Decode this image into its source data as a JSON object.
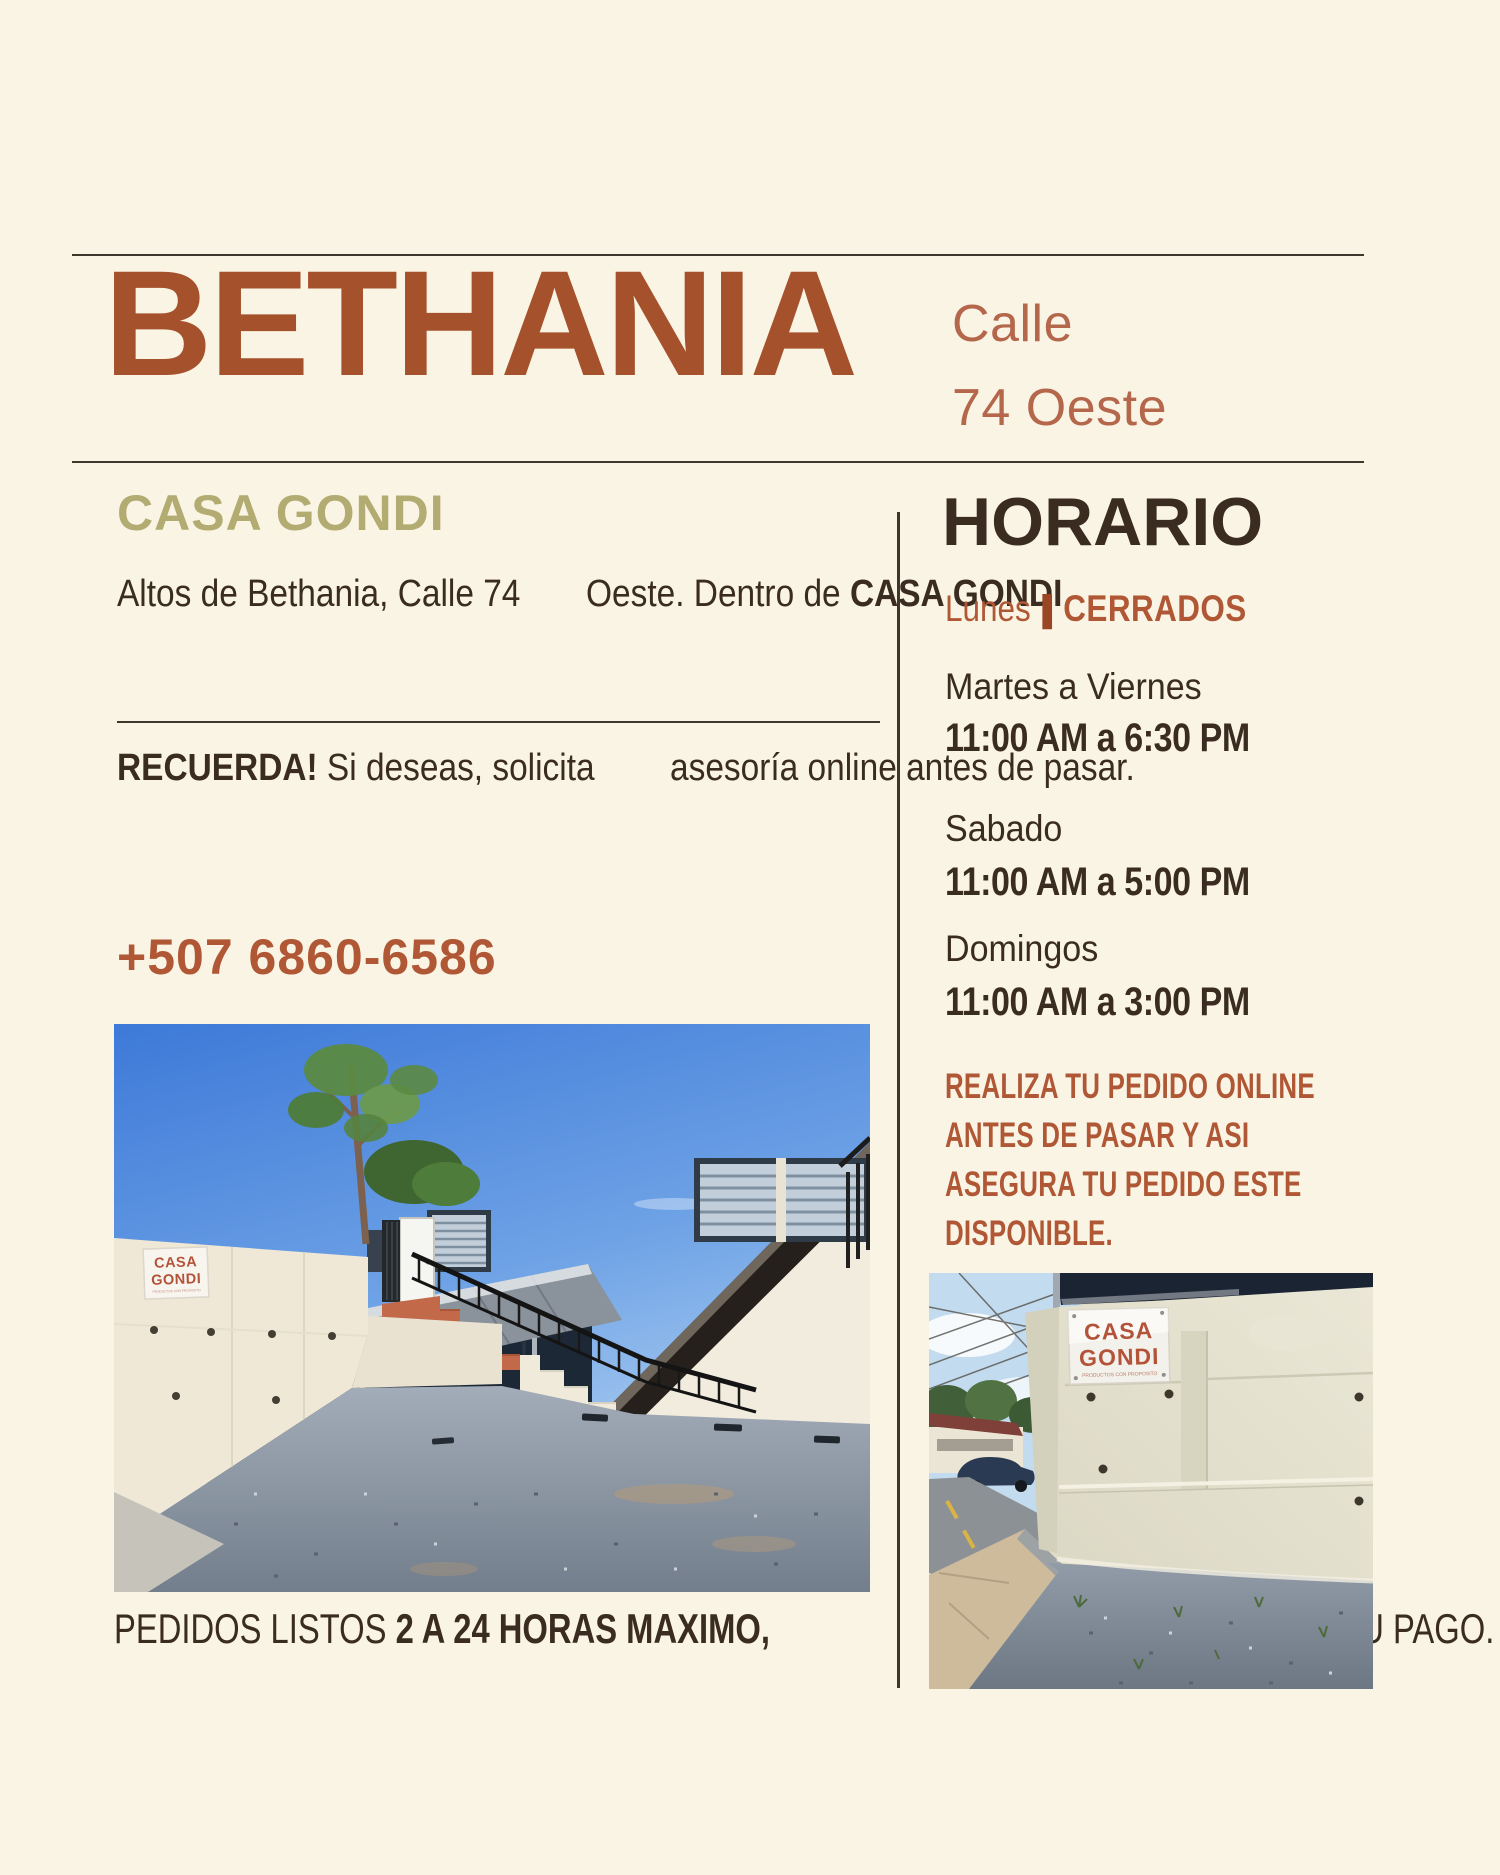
{
  "colors": {
    "background": "#FAF4E5",
    "title": "#A5512C",
    "subtitle": "#B4674B",
    "brand": "#B2AB72",
    "text_dark": "#3B2C21",
    "rust": "#B05836",
    "rust_deep": "#9A4524",
    "line": "#3E352C"
  },
  "header": {
    "title": "BETHANIA",
    "subtitle_line1": "Calle",
    "subtitle_line2": "74 Oeste"
  },
  "left_column": {
    "brand": "CASA GONDI",
    "address_line1": "Altos de Bethania, Calle 74",
    "address_line2_text": "Oeste. Dentro de ",
    "address_line2_emphasis": "CASA GONDI",
    "reminder_emphasis": "RECUERDA!",
    "reminder_line1_rest": " Si deseas, solicita",
    "reminder_line2": "asesoría online antes de pasar.",
    "phone": "+507 6860-6586",
    "pickup_line1_text": "PEDIDOS LISTOS ",
    "pickup_line1_emphasis": "2 A 24 HORAS MAXIMO,",
    "pickup_line2": "LUEGO DE PROCESAR SU PAGO."
  },
  "schedule": {
    "title": "HORARIO",
    "monday_day": "Lunes",
    "monday_separator": "|",
    "monday_status": "CERRADOS",
    "rows": [
      {
        "days": "Martes a Viernes",
        "hours": "11:00 AM a 6:30 PM"
      },
      {
        "days": "Sabado",
        "hours": "11:00 AM a 5:00 PM"
      },
      {
        "days": "Domingos",
        "hours": "11:00 AM a 3:00 PM"
      }
    ],
    "note_line1": "REALIZA TU PEDIDO ONLINE",
    "note_line2": "ANTES DE PASAR Y ASI",
    "note_line3": "ASEGURA TU PEDIDO ESTE",
    "note_line4": "DISPONIBLE."
  },
  "photos": {
    "main": {
      "sign_line1": "CASA",
      "sign_line2": "GONDI",
      "sign_subtitle": "PRODUCTOS CON PROPOSITO"
    },
    "small": {
      "sign_line1": "CASA",
      "sign_line2": "GONDI",
      "sign_subtitle": "PRODUCTOS CON PROPOSITO"
    }
  }
}
